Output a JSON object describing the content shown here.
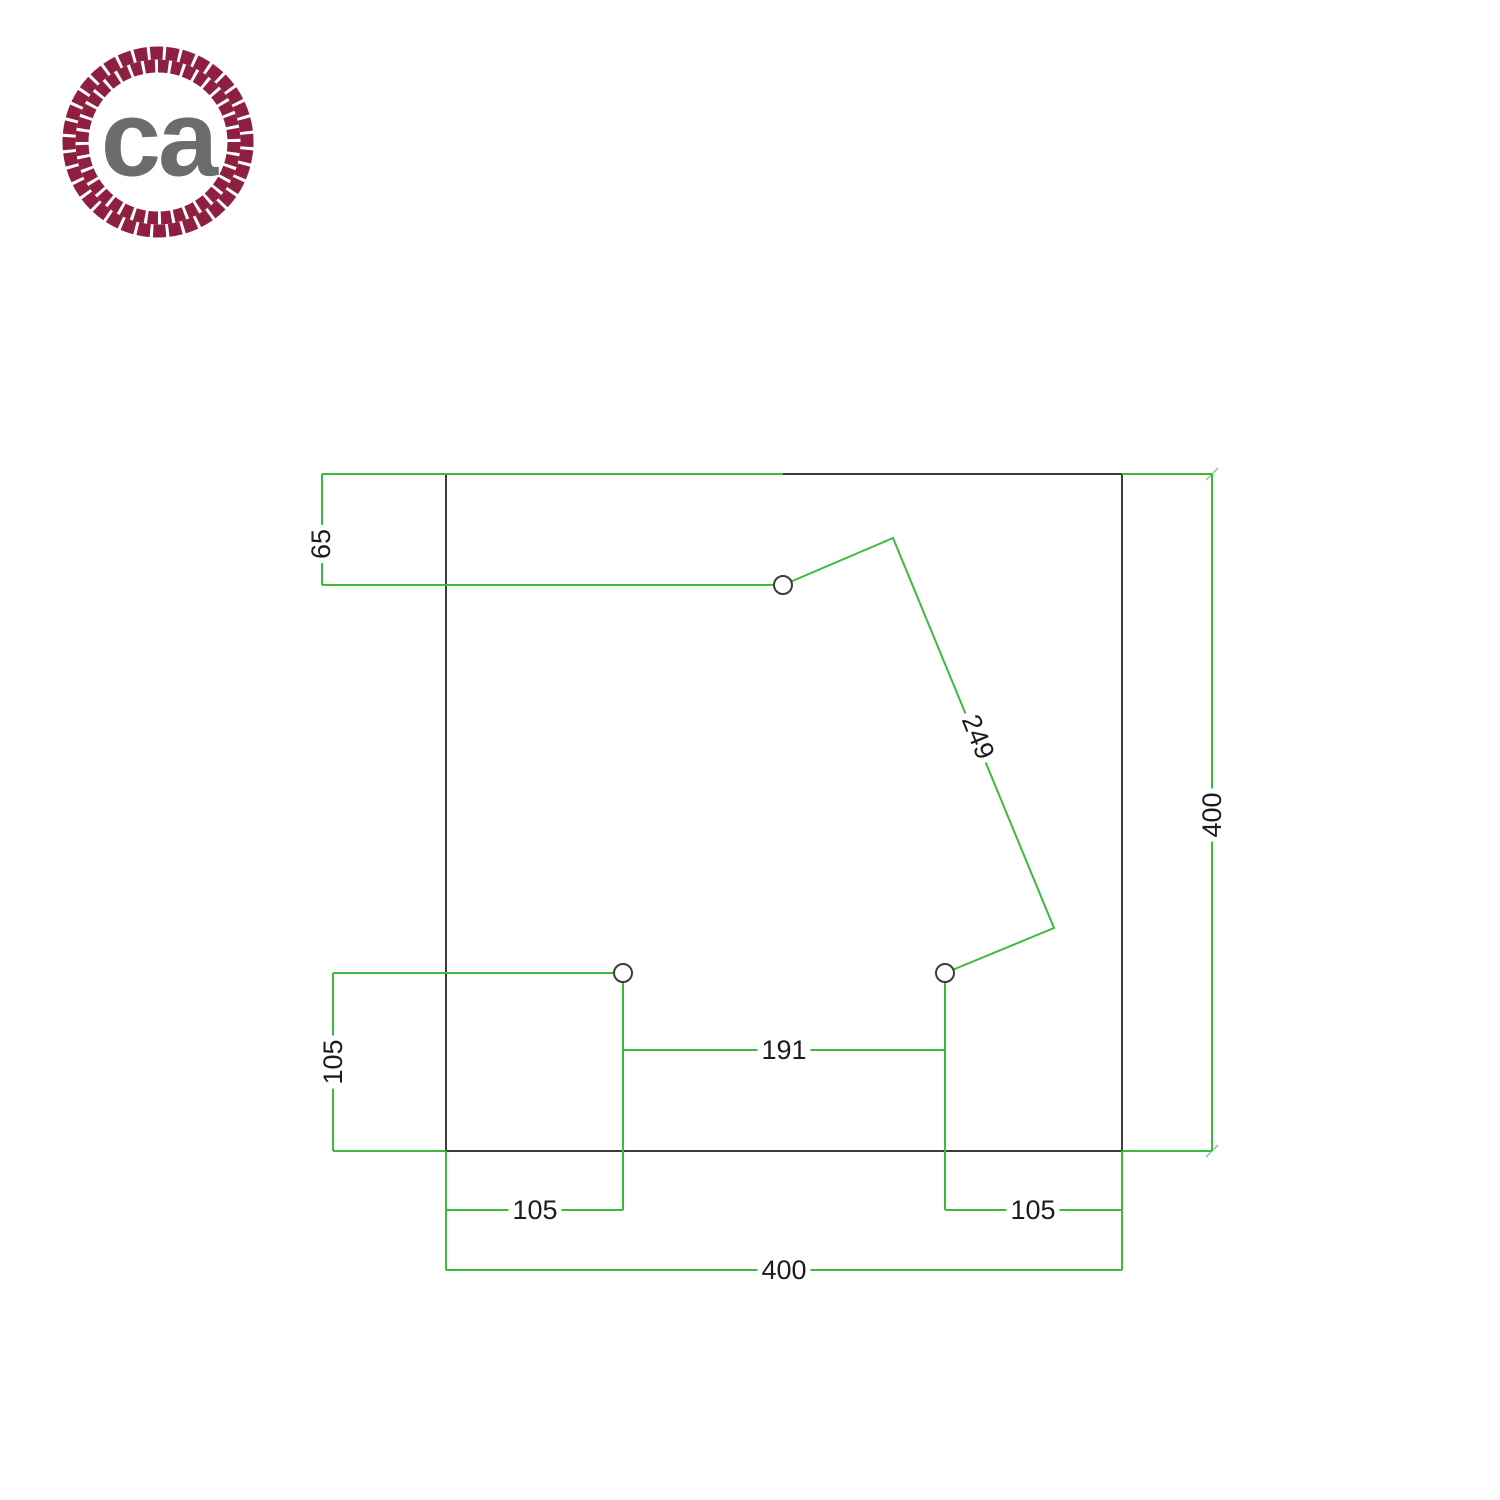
{
  "logo": {
    "text": "ca",
    "rope_color": "#8e1f40",
    "text_color": "#6a6c6e"
  },
  "drawing": {
    "dim_color": "#3dba3d",
    "plate_color": "#3c3c3c",
    "hole_fill": "#ffffff",
    "labels": {
      "top_hole_offset": "65",
      "right_height": "400",
      "diagonal_hole_distance": "249",
      "left_hole_offset": "105",
      "center_hole_spacing": "191",
      "bottom_left_hole_offset": "105",
      "bottom_right_hole_offset": "105",
      "bottom_width": "400"
    }
  }
}
